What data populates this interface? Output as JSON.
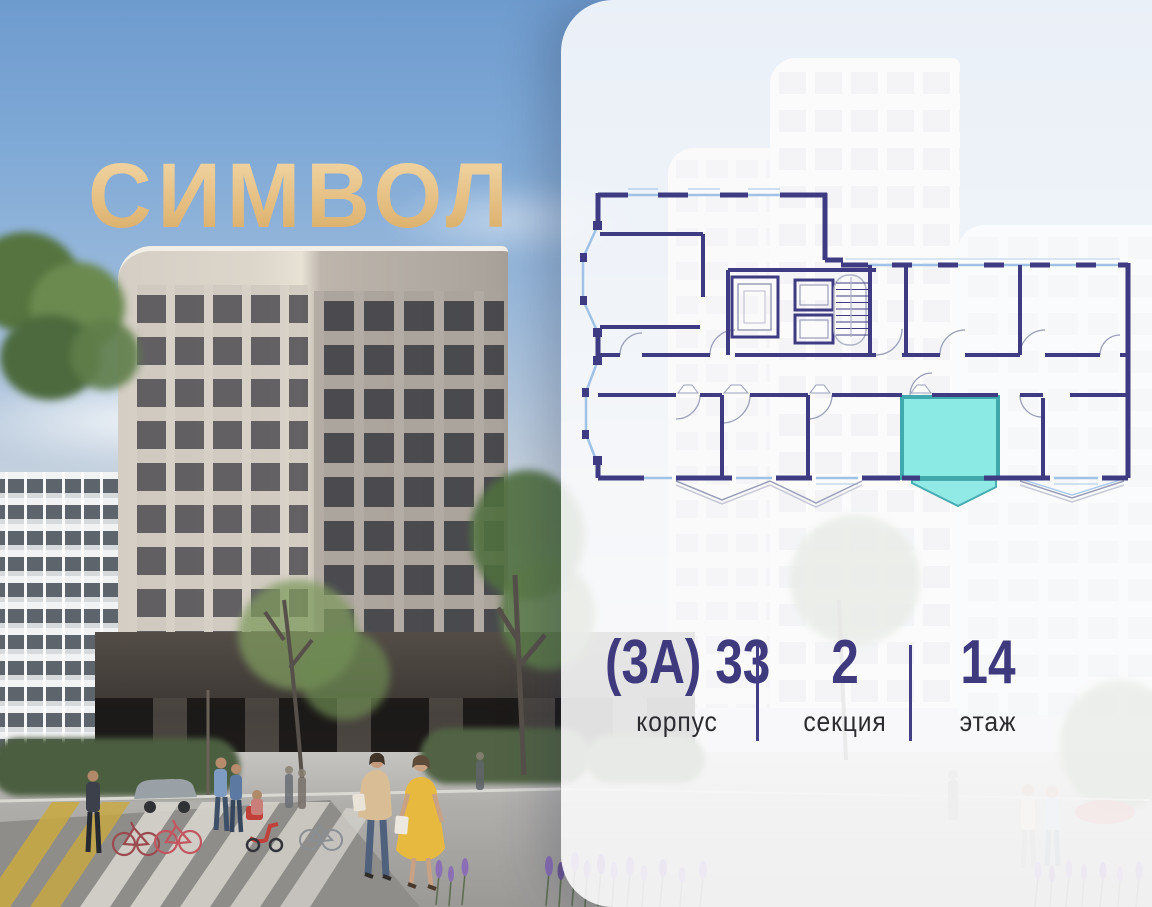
{
  "logo": {
    "text": "СИМВОЛ",
    "gold_top": "#f3d8a8",
    "gold_bottom": "#d9ab64"
  },
  "panel": {
    "background": "rgba(252,252,253,0.88)"
  },
  "floor_plan": {
    "wall_color": "#3f3b82",
    "window_color": "#9fc2e6",
    "highlight_fill": "#8ceae4",
    "highlight_stroke": "#3fa9ad",
    "highlighted_unit": "selected-apartment"
  },
  "stats": [
    {
      "id": "corpus",
      "value": "(3А) 33",
      "label": "корпус"
    },
    {
      "id": "section",
      "value": "2",
      "label": "секция"
    },
    {
      "id": "floor",
      "value": "14",
      "label": "этаж"
    }
  ],
  "accent_color": "#433e86"
}
